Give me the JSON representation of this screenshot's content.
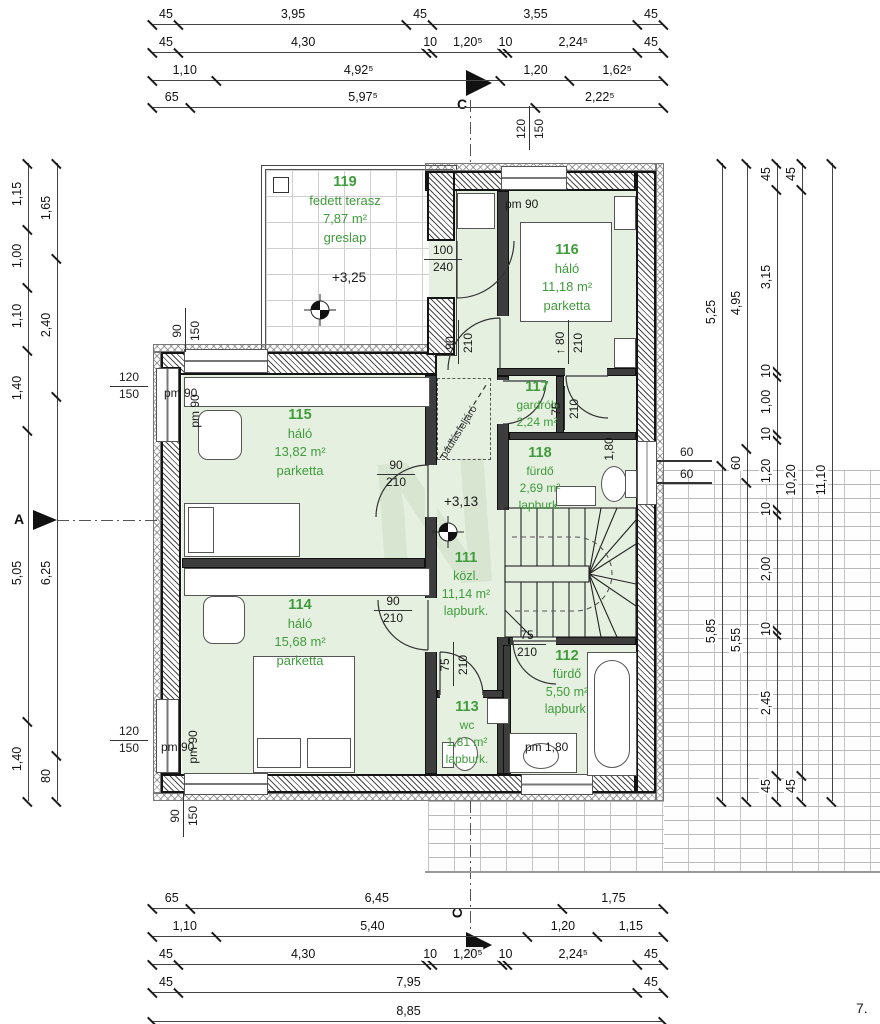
{
  "watermark": "N",
  "axis": {
    "section_top": "C",
    "section_bottom": "C",
    "axis_a": "A",
    "sheet_note": "7."
  },
  "levels": [
    "+3,25",
    "+3,13"
  ],
  "rooms": [
    {
      "number": "119",
      "name": "fedett terasz",
      "area": "7,87 m²",
      "floor": "greslap"
    },
    {
      "number": "116",
      "name": "háló",
      "area": "11,18 m²",
      "floor": "parketta"
    },
    {
      "number": "115",
      "name": "háló",
      "area": "13,82 m²",
      "floor": "parketta"
    },
    {
      "number": "117",
      "name": "gardrób",
      "area": "2,24 m²",
      "floor": ""
    },
    {
      "number": "118",
      "name": "fürdő",
      "area": "2,69 m²",
      "floor": "lapburk."
    },
    {
      "number": "111",
      "name": "közl.",
      "area": "11,14 m²",
      "floor": "lapburk."
    },
    {
      "number": "114",
      "name": "háló",
      "area": "15,68 m²",
      "floor": "parketta"
    },
    {
      "number": "113",
      "name": "wc",
      "area": "1,81 m²",
      "floor": "lapburk."
    },
    {
      "number": "112",
      "name": "fürdő",
      "area": "5,50 m²",
      "floor": "lapburk."
    }
  ],
  "dim_chains": {
    "t1": [
      "45",
      "3,95",
      "45",
      "3,55",
      "45"
    ],
    "t2": [
      "45",
      "4,30",
      "10",
      "1,20⁵",
      "10",
      "2,24⁵",
      "45"
    ],
    "t3": [
      "1,10",
      "4,92⁵",
      "1,20",
      "1,62⁵"
    ],
    "t4": [
      "65",
      "5,97⁵",
      "2,22⁵"
    ],
    "b1": [
      "65",
      "6,45",
      "1,75"
    ],
    "b2": [
      "1,10",
      "5,40",
      "1,20",
      "1,15"
    ],
    "b3": [
      "45",
      "4,30",
      "10",
      "1,20⁵",
      "10",
      "2,24⁵",
      "45"
    ],
    "b4": [
      "45",
      "7,95",
      "45"
    ],
    "b5": [
      "8,85"
    ],
    "l1": [
      "1,15",
      "1,00",
      "1,10",
      "1,40",
      "5,05",
      "1,40"
    ],
    "l2": [
      "1,65",
      "2,40",
      "6,25",
      "80"
    ],
    "r1": [
      "5,25",
      "5,85"
    ],
    "r2": [
      "4,95",
      "60",
      "5,55"
    ],
    "r3": [
      "45",
      "3,15",
      "10",
      "1,00",
      "10",
      "1,20",
      "10",
      "2,00",
      "10",
      "2,45",
      "45"
    ],
    "r4": [
      "45",
      "10,20",
      "45"
    ],
    "r5": [
      "11,10"
    ]
  },
  "openings": [
    {
      "style": "fraction",
      "lines": [
        "100",
        "240"
      ]
    },
    {
      "style": "rot2",
      "lines": [
        "120",
        "150"
      ]
    },
    {
      "style": "plain",
      "lines": [
        "pm 90"
      ]
    },
    {
      "style": "rot2",
      "lines": [
        "90",
        "210"
      ]
    },
    {
      "style": "rot2",
      "lines": [
        "↑ 80",
        "210"
      ]
    },
    {
      "style": "rot2",
      "lines": [
        "90",
        "150"
      ]
    },
    {
      "style": "fraction",
      "lines": [
        "120",
        "150"
      ]
    },
    {
      "style": "plain",
      "lines": [
        "pm 90"
      ]
    },
    {
      "style": "rot",
      "lines": [
        "pm 90"
      ]
    },
    {
      "style": "fraction",
      "lines": [
        "90",
        "210"
      ]
    },
    {
      "style": "rotdiag",
      "lines": [
        "pádlásfeljáró"
      ]
    },
    {
      "style": "rot2",
      "lines": [
        "75",
        "210"
      ]
    },
    {
      "style": "rot",
      "lines": [
        "1,80"
      ]
    },
    {
      "style": "fraction",
      "lines": [
        "90",
        "210"
      ]
    },
    {
      "style": "rot2",
      "lines": [
        "75",
        "210"
      ]
    },
    {
      "style": "fraction",
      "lines": [
        "75",
        "210"
      ]
    },
    {
      "style": "plain",
      "lines": [
        "pm 1,80"
      ]
    },
    {
      "style": "rot2",
      "lines": [
        "90",
        "150"
      ]
    },
    {
      "style": "fraction",
      "lines": [
        "120",
        "150"
      ]
    },
    {
      "style": "plain",
      "lines": [
        "pm 90"
      ]
    },
    {
      "style": "rot",
      "lines": [
        "pm 90"
      ]
    },
    {
      "style": "plain",
      "lines": [
        "60"
      ]
    },
    {
      "style": "plain",
      "lines": [
        "60"
      ]
    }
  ]
}
